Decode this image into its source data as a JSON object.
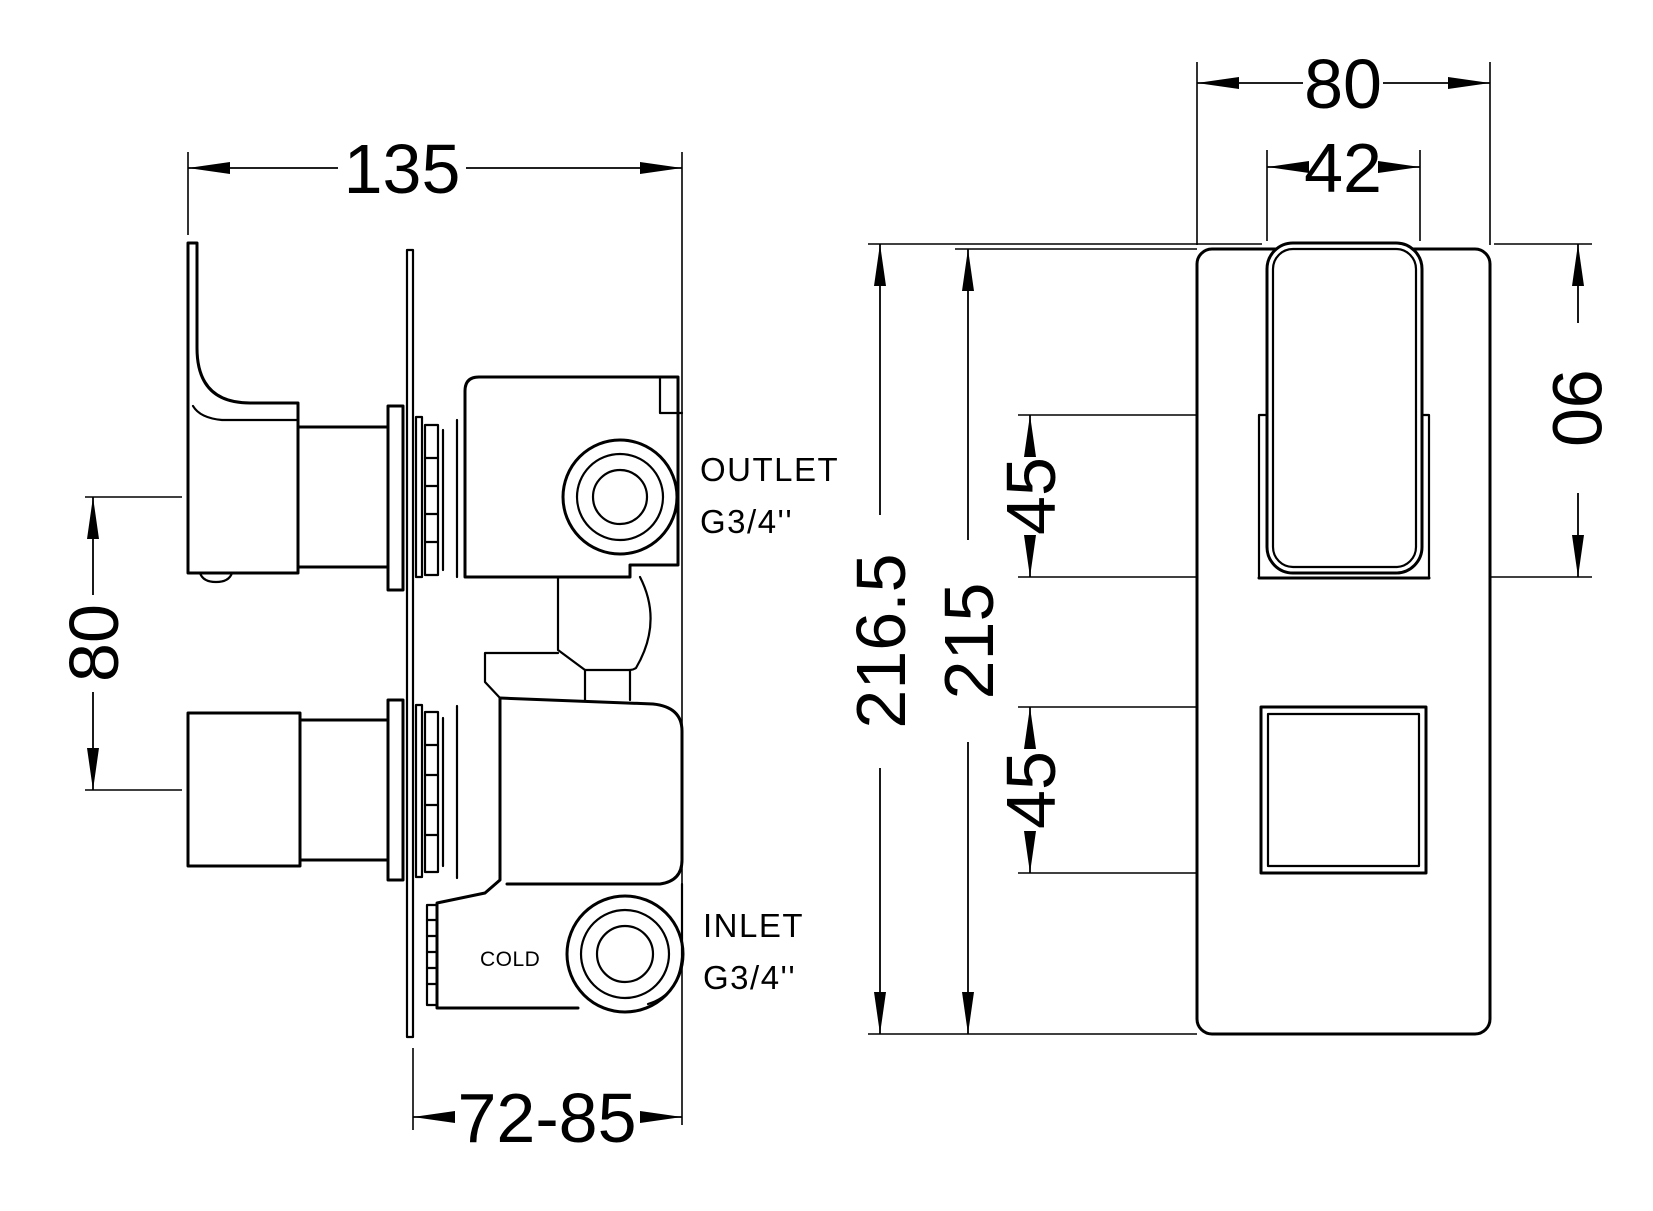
{
  "side_view": {
    "width_dim": "135",
    "handle_spacing_dim": "80",
    "depth_range_dim": "72-85",
    "outlet_label_line1": "OUTLET",
    "outlet_label_line2": "G3/4''",
    "inlet_label_line1": "INLET",
    "inlet_label_line2": "G3/4''",
    "cold_label": "COLD"
  },
  "front_view": {
    "plate_width_dim": "80",
    "handle_width_dim": "42",
    "overall_height_dim": "216.5",
    "plate_height_dim": "215",
    "handle_zone_height_dim": "90",
    "upper_recess_height_dim": "45",
    "lower_square_height_dim": "45"
  },
  "colors": {
    "line": "#000000",
    "background": "#ffffff"
  }
}
